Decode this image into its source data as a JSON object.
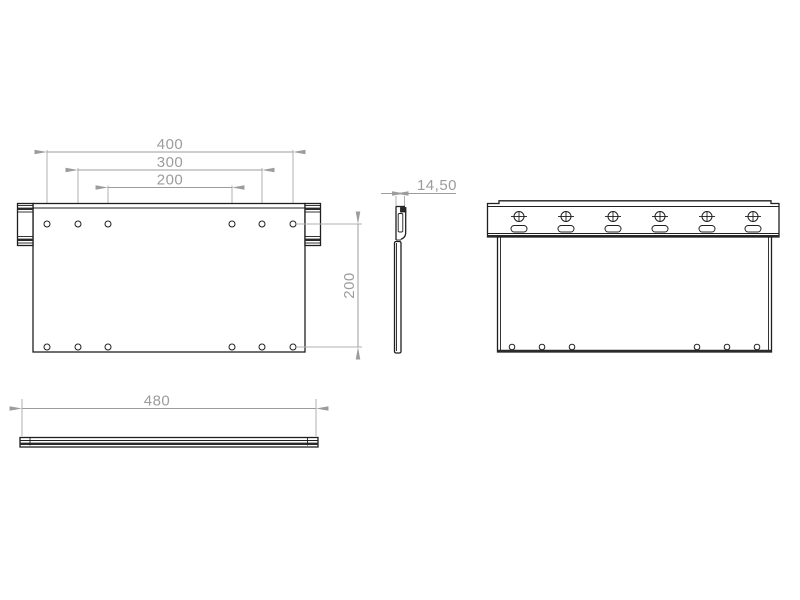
{
  "drawing": {
    "kind": "technical-drawing",
    "part": "wall mount bracket plate",
    "colors": {
      "edge": "#1f1f1f",
      "dimension": "#9c9c9c",
      "background": "#ffffff"
    },
    "views": {
      "front": {
        "label": "front view",
        "top_hole_count": 6,
        "bottom_hole_count": 6,
        "dims": {
          "hole_span_outer": "400",
          "hole_span_middle": "300",
          "hole_span_inner": "200",
          "vertical_hole_span": "200"
        }
      },
      "side": {
        "label": "side profile view",
        "dims": {
          "depth": "14,50"
        }
      },
      "back": {
        "label": "back view with mounting rail",
        "screw_count": 6,
        "slot_count": 6,
        "bottom_hole_count": 6
      },
      "bottom": {
        "label": "top view",
        "dims": {
          "overall_length": "480"
        }
      }
    }
  }
}
